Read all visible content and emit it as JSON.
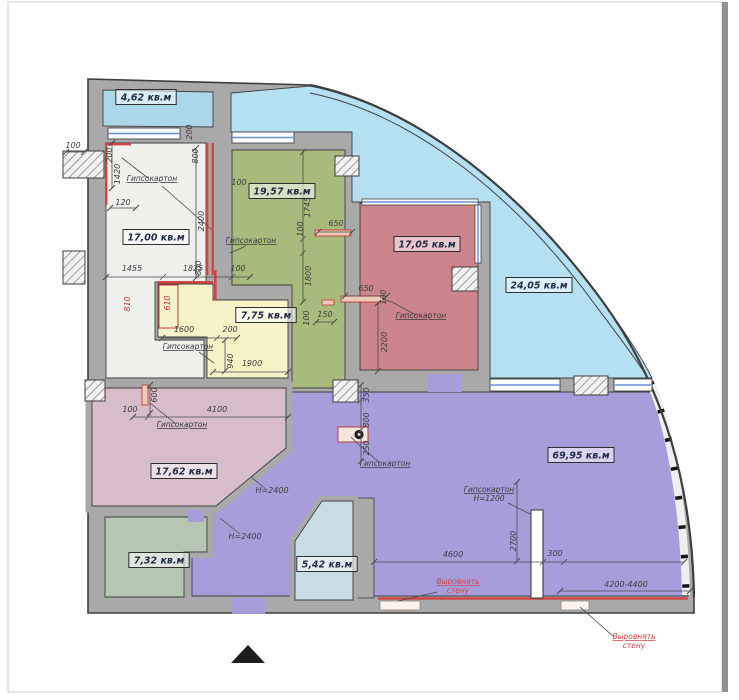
{
  "title": "apartment-floor-plan",
  "colors": {
    "page_bg": "#ffffff",
    "wall_fill": "#a9a9a9",
    "wall_edge": "#3f3f3f",
    "dim_text": "#3d3d3d",
    "dim_red": "#c23a3a",
    "window_glass": "#6a8fd8",
    "drywall_fill": "#ecccb8",
    "drywall_edge": "#c23a3a",
    "note_red": "#d24545",
    "label_text": "#242c48",
    "north_marker": "#1d1d1d"
  },
  "rooms": [
    {
      "id": "balcony",
      "area": "4,62 кв.м",
      "color": "#abd7e9",
      "x": 146,
      "y": 97
    },
    {
      "id": "terrace",
      "area": "24,05 кв.м",
      "color": "#b4e0f2",
      "x": 539,
      "y": 285
    },
    {
      "id": "room-white",
      "area": "17,00 кв.м",
      "color": "#f0f0ed",
      "x": 156,
      "y": 237
    },
    {
      "id": "room-green",
      "area": "19,57 кв.м",
      "color": "#a9ba7d",
      "x": 282,
      "y": 191
    },
    {
      "id": "room-red",
      "area": "17,05 кв.м",
      "color": "#cb8489",
      "x": 427,
      "y": 244
    },
    {
      "id": "room-yellow",
      "area": "7,75 кв.м",
      "color": "#f7f3c8",
      "x": 266,
      "y": 315
    },
    {
      "id": "room-pink",
      "area": "17,62 кв.м",
      "color": "#d6bdc9",
      "x": 184,
      "y": 471
    },
    {
      "id": "room-purple",
      "area": "69,95 кв.м",
      "color": "#a89ddb",
      "x": 581,
      "y": 455
    },
    {
      "id": "room-sage",
      "area": "7,32 кв.м",
      "color": "#b5c6b2",
      "x": 159,
      "y": 560
    },
    {
      "id": "room-blue",
      "area": "5,42 кв.м",
      "color": "#c8dce6",
      "x": 327,
      "y": 564
    }
  ],
  "dimensions": [
    {
      "t": "100",
      "x": 73,
      "y": 148
    },
    {
      "t": "200",
      "x": 112,
      "y": 155,
      "r": 90
    },
    {
      "t": "1420",
      "x": 120,
      "y": 174,
      "r": 90
    },
    {
      "t": "200",
      "x": 192,
      "y": 132,
      "r": 90
    },
    {
      "t": "800",
      "x": 198,
      "y": 156,
      "r": 90
    },
    {
      "t": "120",
      "x": 123,
      "y": 205
    },
    {
      "t": "2400",
      "x": 204,
      "y": 221,
      "r": 90
    },
    {
      "t": "100",
      "x": 239,
      "y": 185
    },
    {
      "t": "1745",
      "x": 310,
      "y": 207,
      "r": 90
    },
    {
      "t": "100",
      "x": 303,
      "y": 229,
      "r": 90
    },
    {
      "t": "650",
      "x": 336,
      "y": 226
    },
    {
      "t": "1800",
      "x": 311,
      "y": 276,
      "r": 90
    },
    {
      "t": "100",
      "x": 309,
      "y": 318,
      "r": 90
    },
    {
      "t": "150",
      "x": 325,
      "y": 317
    },
    {
      "t": "650",
      "x": 366,
      "y": 291
    },
    {
      "t": "100",
      "x": 386,
      "y": 297,
      "r": 90
    },
    {
      "t": "2200",
      "x": 387,
      "y": 342,
      "r": 90
    },
    {
      "t": "1455",
      "x": 132,
      "y": 271
    },
    {
      "t": "1825",
      "x": 193,
      "y": 271
    },
    {
      "t": "800",
      "x": 201,
      "y": 268,
      "r": 90
    },
    {
      "t": "100",
      "x": 238,
      "y": 271
    },
    {
      "t": "810",
      "x": 130,
      "y": 304,
      "r": 90,
      "c": "red"
    },
    {
      "t": "610",
      "x": 170,
      "y": 303,
      "r": 90,
      "c": "red"
    },
    {
      "t": "1600",
      "x": 184,
      "y": 332
    },
    {
      "t": "200",
      "x": 230,
      "y": 332
    },
    {
      "t": "940",
      "x": 233,
      "y": 361,
      "r": 90
    },
    {
      "t": "1900",
      "x": 252,
      "y": 366
    },
    {
      "t": "600",
      "x": 157,
      "y": 395,
      "r": 90
    },
    {
      "t": "100",
      "x": 130,
      "y": 412
    },
    {
      "t": "4100",
      "x": 217,
      "y": 412
    },
    {
      "t": "350",
      "x": 369,
      "y": 395,
      "r": 90
    },
    {
      "t": "800",
      "x": 369,
      "y": 420,
      "r": 90
    },
    {
      "t": "250",
      "x": 369,
      "y": 448,
      "r": 90
    },
    {
      "t": "H=2400",
      "x": 272,
      "y": 493
    },
    {
      "t": "H=2400",
      "x": 245,
      "y": 539
    },
    {
      "t": "4600",
      "x": 453,
      "y": 557
    },
    {
      "t": "2700",
      "x": 516,
      "y": 541,
      "r": 90
    },
    {
      "t": "300",
      "x": 555,
      "y": 556
    },
    {
      "t": "4200-4400",
      "x": 626,
      "y": 587
    }
  ],
  "dim_lines": [
    {
      "p": [
        106,
        277,
        250,
        277
      ],
      "t": 1
    },
    {
      "p": [
        160,
        280,
        166,
        274
      ],
      "t": 0
    },
    {
      "p": [
        229,
        280,
        235,
        274
      ],
      "t": 0
    },
    {
      "p": [
        196,
        148,
        196,
        278
      ],
      "t": 1
    },
    {
      "p": [
        112,
        143,
        112,
        188
      ],
      "t": 1
    },
    {
      "p": [
        66,
        152,
        84,
        152
      ],
      "t": 1
    },
    {
      "p": [
        110,
        208,
        136,
        208
      ],
      "t": 1
    },
    {
      "p": [
        303,
        152,
        303,
        302
      ],
      "t": 1
    },
    {
      "p": [
        300,
        242,
        306,
        236
      ],
      "t": 0
    },
    {
      "p": [
        300,
        256,
        306,
        250
      ],
      "t": 0
    },
    {
      "p": [
        318,
        232,
        352,
        232
      ],
      "t": 1
    },
    {
      "p": [
        316,
        322,
        334,
        322
      ],
      "t": 1
    },
    {
      "p": [
        345,
        296,
        387,
        296
      ],
      "t": 1
    },
    {
      "p": [
        378,
        303,
        378,
        371
      ],
      "t": 1
    },
    {
      "p": [
        162,
        338,
        237,
        338
      ],
      "t": 1
    },
    {
      "p": [
        214,
        341,
        220,
        335
      ],
      "t": 0
    },
    {
      "p": [
        225,
        340,
        225,
        371
      ],
      "t": 1
    },
    {
      "p": [
        213,
        372,
        288,
        372
      ],
      "t": 1
    },
    {
      "p": [
        133,
        417,
        288,
        417
      ],
      "t": 1
    },
    {
      "p": [
        145,
        420,
        151,
        414
      ],
      "t": 0
    },
    {
      "p": [
        150,
        385,
        150,
        413
      ],
      "t": 1
    },
    {
      "p": [
        361,
        385,
        361,
        461
      ],
      "t": 1
    },
    {
      "p": [
        358,
        403,
        364,
        397
      ],
      "t": 0
    },
    {
      "p": [
        358,
        433,
        364,
        427
      ],
      "t": 0
    },
    {
      "p": [
        374,
        562,
        684,
        562
      ],
      "t": 1
    },
    {
      "p": [
        540,
        565,
        546,
        559
      ],
      "t": 0
    },
    {
      "p": [
        561,
        565,
        567,
        559
      ],
      "t": 0
    },
    {
      "p": [
        517,
        482,
        517,
        561
      ],
      "t": 1
    },
    {
      "p": [
        560,
        591,
        690,
        591
      ],
      "t": 1
    }
  ],
  "leaders": [
    [
      [
        148,
        178
      ],
      [
        122,
        158
      ]
    ],
    [
      [
        162,
        186
      ],
      [
        212,
        230
      ]
    ],
    [
      [
        246,
        246
      ],
      [
        230,
        253
      ]
    ],
    [
      [
        199,
        352
      ],
      [
        214,
        363
      ]
    ],
    [
      [
        416,
        315
      ],
      [
        392,
        302
      ],
      [
        382,
        299
      ]
    ],
    [
      [
        176,
        424
      ],
      [
        150,
        403
      ]
    ],
    [
      [
        380,
        463
      ],
      [
        358,
        444
      ],
      [
        351,
        437
      ]
    ],
    [
      [
        508,
        503
      ],
      [
        530,
        514
      ]
    ],
    [
      [
        266,
        489
      ],
      [
        251,
        477
      ]
    ],
    [
      [
        240,
        534
      ],
      [
        220,
        518
      ]
    ]
  ],
  "annotations": [
    {
      "text": "Гипсокартон",
      "x": 152,
      "y": 181
    },
    {
      "text": "Гипсокартон",
      "x": 251,
      "y": 243
    },
    {
      "text": "Гипсокартон",
      "x": 188,
      "y": 349
    },
    {
      "text": "Гипсокартон",
      "x": 421,
      "y": 318
    },
    {
      "text": "Гипсокартон",
      "x": 182,
      "y": 427
    },
    {
      "text": "Гипсокартон",
      "x": 385,
      "y": 466
    },
    {
      "text": "Гипсокартон",
      "x": 489,
      "y": 492,
      "text2": "H=1200"
    }
  ],
  "red_notes": [
    {
      "lines": [
        "Выровнять",
        "стену"
      ],
      "x": 458,
      "y": 584,
      "leader": [
        [
          437,
          592
        ],
        [
          398,
          601
        ]
      ]
    },
    {
      "lines": [
        "Выровнять",
        "стену"
      ],
      "x": 634,
      "y": 639,
      "leader": [
        [
          614,
          637
        ],
        [
          580,
          607
        ]
      ]
    }
  ]
}
